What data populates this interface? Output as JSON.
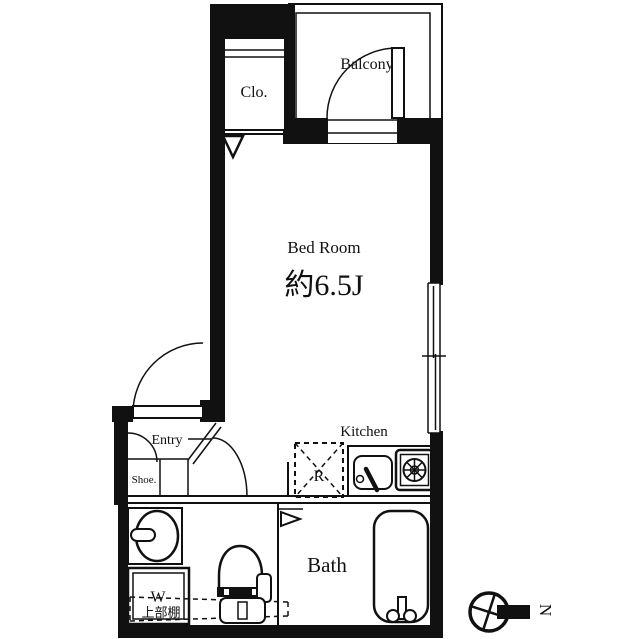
{
  "canvas": {
    "width": 640,
    "height": 639,
    "background": "#ffffff",
    "ink": "#111111"
  },
  "floorplan": {
    "rooms": {
      "closet": {
        "label": "Clo."
      },
      "balcony": {
        "label": "Balcony"
      },
      "bedroom": {
        "label": "Bed Room",
        "size": "約6.5J"
      },
      "entry": {
        "label": "Entry",
        "shoe": "Shoe."
      },
      "kitchen": {
        "label": "Kitchen",
        "refrigerator": "R"
      },
      "bath": {
        "label": "Bath"
      },
      "laundry": {
        "label": "W",
        "shelf": "上部棚"
      }
    },
    "compass": {
      "north": "N"
    }
  }
}
